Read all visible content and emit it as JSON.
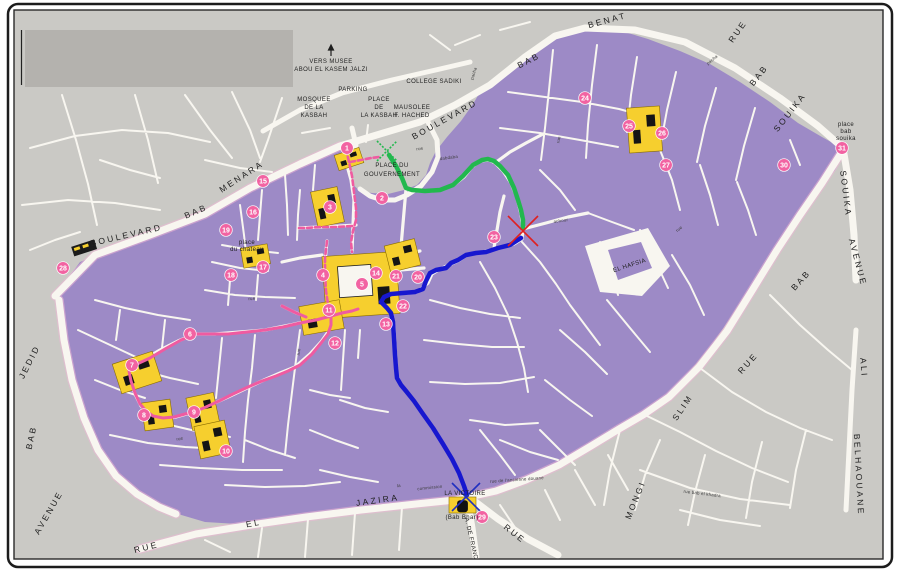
{
  "map": {
    "description": "Scanned tourist street map of the Medina of Tunis with numbered landmarks and colored walking routes",
    "colors": {
      "map_bg": "#cac9c5",
      "street": "#f8f6f0",
      "medina": "#9d8ac6",
      "yellow": "#f6cf2e",
      "marker": "#f263a2",
      "route_green": "#22b84e",
      "route_blue": "#1717cf",
      "route_pink": "#ef5ba1",
      "x_red": "#e02020",
      "x_blue": "#2030c0",
      "x_green": "#22b84e",
      "legend_box": "#b4b2ae",
      "frame": "#1c1c1c",
      "label": "#1f1f1f"
    },
    "boundary_labels": [
      {
        "t": "BOULEVARD",
        "x": 127,
        "y": 238,
        "r": -13
      },
      {
        "t": "BAB",
        "x": 197,
        "y": 214,
        "r": -23
      },
      {
        "t": "MENARA",
        "x": 243,
        "y": 179,
        "r": -33
      },
      {
        "t": "BOULEVARD",
        "x": 446,
        "y": 122,
        "r": -29
      },
      {
        "t": "BAB",
        "x": 530,
        "y": 63,
        "r": -27
      },
      {
        "t": "BENAT",
        "x": 608,
        "y": 23,
        "r": -15
      },
      {
        "t": "RUE",
        "x": 740,
        "y": 33,
        "r": -55
      },
      {
        "t": "BAB",
        "x": 761,
        "y": 77,
        "r": -52
      },
      {
        "t": "SOUIKA",
        "x": 792,
        "y": 114,
        "r": -52
      },
      {
        "t": "SOUIKA",
        "x": 843,
        "y": 194,
        "r": 83
      },
      {
        "t": "AVENUE",
        "x": 855,
        "y": 263,
        "r": 75
      },
      {
        "t": "BAB",
        "x": 803,
        "y": 282,
        "r": -48
      },
      {
        "t": "RUE",
        "x": 750,
        "y": 365,
        "r": -48
      },
      {
        "t": "SLIM",
        "x": 685,
        "y": 409,
        "r": -56
      },
      {
        "t": "MONGI",
        "x": 638,
        "y": 501,
        "r": -68
      },
      {
        "t": "ALI",
        "x": 861,
        "y": 368,
        "r": 86
      },
      {
        "t": "BELHAOUANE",
        "x": 856,
        "y": 475,
        "r": 87
      },
      {
        "t": "JEDID",
        "x": 32,
        "y": 363,
        "r": -63
      },
      {
        "t": "BAB",
        "x": 34,
        "y": 438,
        "r": -78
      },
      {
        "t": "AVENUE",
        "x": 51,
        "y": 514,
        "r": -60
      },
      {
        "t": "RUE",
        "x": 147,
        "y": 550,
        "r": -14
      },
      {
        "t": "EL",
        "x": 254,
        "y": 526,
        "r": -10
      },
      {
        "t": "JAZIRA",
        "x": 378,
        "y": 503,
        "r": -8
      },
      {
        "t": "RUE",
        "x": 513,
        "y": 536,
        "r": 38
      }
    ],
    "place_labels": [
      {
        "t": "VERS MUSEE",
        "x": 331,
        "y": 63
      },
      {
        "t": "ABOU EL KASEM JALZI",
        "x": 331,
        "y": 71
      },
      {
        "t": "PARKING",
        "x": 353,
        "y": 91
      },
      {
        "t": "PLACE",
        "x": 379,
        "y": 101
      },
      {
        "t": "DE",
        "x": 379,
        "y": 109
      },
      {
        "t": "LA KASBAH",
        "x": 379,
        "y": 117
      },
      {
        "t": "MOSQUEE",
        "x": 314,
        "y": 101
      },
      {
        "t": "DE LA",
        "x": 314,
        "y": 109
      },
      {
        "t": "KASBAH",
        "x": 314,
        "y": 117
      },
      {
        "t": "COLLEGE SADIKI",
        "x": 434,
        "y": 83
      },
      {
        "t": "MAUSOLEE",
        "x": 412,
        "y": 109
      },
      {
        "t": "F. HACHED",
        "x": 412,
        "y": 117
      },
      {
        "t": "PLACE DU",
        "x": 392,
        "y": 167
      },
      {
        "t": "GOUVERNEMENT",
        "x": 392,
        "y": 176
      },
      {
        "t": "place",
        "x": 247,
        "y": 244
      },
      {
        "t": "du chateau",
        "x": 247,
        "y": 251
      },
      {
        "t": "EL HAFSIA",
        "x": 630,
        "y": 267,
        "r": -18
      },
      {
        "t": "LA VICTOIRE",
        "x": 465,
        "y": 495
      },
      {
        "t": "(Bab Bhar)",
        "x": 462,
        "y": 519
      },
      {
        "t": "place",
        "x": 846,
        "y": 126
      },
      {
        "t": "bab",
        "x": 846,
        "y": 133
      },
      {
        "t": "souika",
        "x": 846,
        "y": 140
      },
      {
        "t": "A. DE FRANCE",
        "x": 470,
        "y": 541,
        "r": 77
      }
    ],
    "small_labels": [
      {
        "t": "rue de l'ancienne douane",
        "x": 517,
        "y": 481,
        "r": -4
      },
      {
        "t": "la",
        "x": 399,
        "y": 487,
        "r": -6
      },
      {
        "t": "commission",
        "x": 430,
        "y": 489,
        "r": -6
      },
      {
        "t": "rue bab el khadra",
        "x": 702,
        "y": 495,
        "r": 7
      },
      {
        "t": "achour",
        "x": 561,
        "y": 222,
        "r": -8
      },
      {
        "t": "pacha",
        "x": 475,
        "y": 74,
        "r": -72
      },
      {
        "t": "pacha",
        "x": 713,
        "y": 61,
        "r": -40
      },
      {
        "t": "dabdaba",
        "x": 449,
        "y": 159,
        "r": -8
      },
      {
        "t": "rue",
        "x": 420,
        "y": 150,
        "r": -8
      },
      {
        "t": "rue",
        "x": 560,
        "y": 140,
        "r": -80
      },
      {
        "t": "rue",
        "x": 300,
        "y": 352,
        "r": -85
      },
      {
        "t": "rue",
        "x": 252,
        "y": 300,
        "r": -5
      },
      {
        "t": "rue",
        "x": 680,
        "y": 230,
        "r": -40
      },
      {
        "t": "rue",
        "x": 180,
        "y": 440,
        "r": -10
      }
    ],
    "markers": [
      {
        "n": "1",
        "x": 347,
        "y": 148
      },
      {
        "n": "2",
        "x": 382,
        "y": 198
      },
      {
        "n": "3",
        "x": 330,
        "y": 207
      },
      {
        "n": "4",
        "x": 323,
        "y": 275
      },
      {
        "n": "5",
        "x": 362,
        "y": 284
      },
      {
        "n": "6",
        "x": 190,
        "y": 334
      },
      {
        "n": "7",
        "x": 132,
        "y": 365
      },
      {
        "n": "8",
        "x": 144,
        "y": 415
      },
      {
        "n": "9",
        "x": 194,
        "y": 412
      },
      {
        "n": "10",
        "x": 226,
        "y": 451
      },
      {
        "n": "11",
        "x": 329,
        "y": 310
      },
      {
        "n": "12",
        "x": 335,
        "y": 343
      },
      {
        "n": "13",
        "x": 386,
        "y": 324
      },
      {
        "n": "14",
        "x": 376,
        "y": 273
      },
      {
        "n": "15",
        "x": 263,
        "y": 181
      },
      {
        "n": "16",
        "x": 253,
        "y": 212
      },
      {
        "n": "17",
        "x": 263,
        "y": 267
      },
      {
        "n": "18",
        "x": 231,
        "y": 275
      },
      {
        "n": "19",
        "x": 226,
        "y": 230
      },
      {
        "n": "20",
        "x": 418,
        "y": 277
      },
      {
        "n": "21",
        "x": 396,
        "y": 276
      },
      {
        "n": "22",
        "x": 403,
        "y": 306
      },
      {
        "n": "23",
        "x": 494,
        "y": 237
      },
      {
        "n": "24",
        "x": 585,
        "y": 98
      },
      {
        "n": "25",
        "x": 629,
        "y": 126
      },
      {
        "n": "26",
        "x": 662,
        "y": 133
      },
      {
        "n": "27",
        "x": 666,
        "y": 165
      },
      {
        "n": "28",
        "x": 63,
        "y": 268
      },
      {
        "n": "29",
        "x": 482,
        "y": 517
      },
      {
        "n": "30",
        "x": 784,
        "y": 165
      },
      {
        "n": "31",
        "x": 842,
        "y": 148
      }
    ],
    "routes": {
      "green": "389,155 396,166 402,178 406,188 412,190 425,191 440,190 453,185 463,176 473,165 482,160 488,159 494,161 500,166 508,175 514,188 518,200 521,210 523,220 523,228",
      "blue": "521,238 510,245 498,248 486,252 476,253 466,255 458,260 451,263 446,268 436,270 430,273 426,281 423,289 415,292 403,293 391,294 384,297 381,302 387,308 391,313 393,322 394,338 395,355 396,368 397,378 401,385 406,391 414,401 423,414 433,428 443,444 452,459 459,473 464,486 467,495",
      "pink_solid": [
        "331,316 316,320 300,323 283,327 265,330 247,332 228,334 210,334 196,334 181,340 165,349 150,358 137,364 129,371 131,381 135,393 140,404 146,411 153,416 163,418 174,417 185,414 194,412 206,407 219,401 233,394 248,387 262,381 276,376 288,371 300,365 312,354 321,343 328,334 331,325 331,316",
        "331,316 342,313 352,311 358,309",
        "306,317 294,312 282,306"
      ],
      "pink_dashed": [
        "346,149 349,162 352,176 354,192 356,208 356,220 353,231 351,242 352,252",
        "352,226 336,227 320,227 306,228 299,228",
        "327,241 325,258 325,275 326,291 328,304 331,314",
        "350,162 361,160 371,158 379,157"
      ]
    },
    "x_marks": [
      {
        "kind": "green",
        "x": 387,
        "y": 151,
        "s": 10
      },
      {
        "kind": "red",
        "x": 523,
        "y": 231,
        "s": 15
      },
      {
        "kind": "blue",
        "x": 466,
        "y": 497,
        "s": 14
      }
    ],
    "landmarks": [
      {
        "x": 336,
        "y": 151,
        "w": 26,
        "h": 16,
        "r": -18
      },
      {
        "x": 314,
        "y": 189,
        "w": 27,
        "h": 36,
        "r": -12
      },
      {
        "x": 242,
        "y": 246,
        "w": 27,
        "h": 20,
        "r": -10
      },
      {
        "x": 324,
        "y": 254,
        "w": 74,
        "h": 62,
        "r": -4,
        "courtyard": true
      },
      {
        "x": 387,
        "y": 242,
        "w": 31,
        "h": 27,
        "r": -14
      },
      {
        "x": 301,
        "y": 303,
        "w": 41,
        "h": 29,
        "r": -10
      },
      {
        "x": 116,
        "y": 357,
        "w": 42,
        "h": 31,
        "r": -18
      },
      {
        "x": 143,
        "y": 401,
        "w": 29,
        "h": 28,
        "r": -8
      },
      {
        "x": 189,
        "y": 395,
        "w": 28,
        "h": 33,
        "r": -12
      },
      {
        "x": 197,
        "y": 423,
        "w": 31,
        "h": 33,
        "r": -12
      },
      {
        "x": 628,
        "y": 107,
        "w": 33,
        "h": 45,
        "r": -4
      },
      {
        "x": 449,
        "y": 497,
        "w": 27,
        "h": 16,
        "r": 0,
        "gate": true
      }
    ]
  }
}
